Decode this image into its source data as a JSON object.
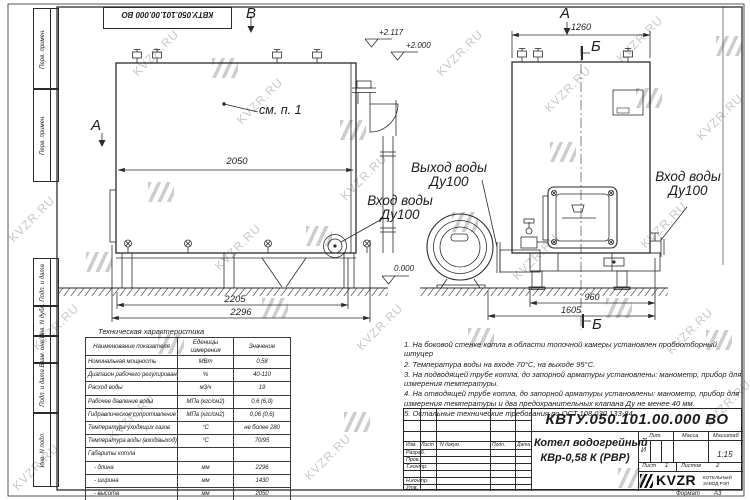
{
  "watermark": {
    "text": "KVZR.RU"
  },
  "frame": {
    "top_doc_number": "КВТУ.050.101.00.000 ВО",
    "left_strip": {
      "cells": [
        "Перв. примен.",
        "Перв. примен.",
        "Подп. и дата",
        "Инв. N дубл.",
        "Взам. инв. N",
        "Подп. и дата",
        "Инв. N подл."
      ]
    },
    "format_label": "Формат",
    "format_value": "А3"
  },
  "views": {
    "side": {
      "view_label_top": "В",
      "view_label_left": "А",
      "detail_ref": "см. п. 1",
      "dim_body": "2050",
      "dim_frame": "2205",
      "dim_total": "2296",
      "elev_top": "+2.117",
      "elev_mid": "+2.000",
      "elev_zero": "0.000",
      "outlet_label_line1": "Выход воды",
      "outlet_label_line2": "Ду100",
      "inlet_label_line1": "Вход воды",
      "inlet_label_line2": "Ду100"
    },
    "front": {
      "view_label_top": "А",
      "section_label_top": "Б",
      "section_label_bottom": "Б",
      "dim_top": "1260",
      "dim_base": "960",
      "dim_total": "1605",
      "inlet_label_line1": "Вход воды",
      "inlet_label_line2": "Ду100"
    }
  },
  "spec_table": {
    "title": "Техническая характеристика",
    "col_headers": [
      "Наименование показателя",
      "Еденицы измерения",
      "Значение"
    ],
    "rows": [
      [
        "Номинальная мощность",
        "МВт",
        "0,58"
      ],
      [
        "Диапазон рабочего регулирования",
        "%",
        "40-110"
      ],
      [
        "Расход воды",
        "м3/ч",
        "19"
      ],
      [
        "Рабочее давление воды",
        "МПа (кгс/см2)",
        "0,6 (6,0)"
      ],
      [
        "Гидравлическое сопротивление котла",
        "МПа (кгс/см2)",
        "0,06 (0,6)"
      ],
      [
        "Температура уходящих газов",
        "°С",
        "не более 280"
      ],
      [
        "Температура воды (вход/выход)",
        "°С",
        "70/95"
      ],
      [
        "Габариты котла",
        "",
        ""
      ],
      [
        "- длина",
        "мм",
        "2296"
      ],
      [
        "- ширина",
        "мм",
        "1430"
      ],
      [
        "- высота",
        "мм",
        "2050"
      ]
    ]
  },
  "notes": [
    "1. На боковой стенке котла в области топочной камеры установлен пробоотборный штуцер",
    "2. Температура воды на входе 70°С, на выходе 95°С.",
    "3. На подводящей трубе котла, до запорной арматуры установлены: манометр, прибор для измерения температуры.",
    "4. На отводящей трубе котла, до запорной арматуры установлены: манометр, прибор для измерения температуры и два предохранительных клапана Ду не менее 40 мм.",
    "5. Остальные технические требования по ОСТ 108.030.133-84."
  ],
  "title_block": {
    "doc_number": "КВТУ.050.101.00.000  ВО",
    "product_name_line1": "Котел водогрейный",
    "product_name_line2": "КВр-0,58 К (РВР)",
    "header_cols": [
      "Изм.",
      "Лист",
      "N докум.",
      "Подп.",
      "Дата"
    ],
    "row_labels": [
      "Разраб.",
      "Пров.",
      "Т.контр.",
      "",
      "Н.контр.",
      "Утв."
    ],
    "lit_label": "Лит.",
    "lit_value": "И",
    "mass_label": "Масса",
    "scale_label": "Масштаб",
    "scale_value": "1:15",
    "sheet_label": "Лист",
    "sheet_value": "1",
    "sheets_label": "Листов",
    "sheets_value": "2",
    "company_logo": "KVZR",
    "company_line1": "КОТЕЛЬНЫЙ",
    "company_line2": "ЗАВОД РЭП"
  }
}
